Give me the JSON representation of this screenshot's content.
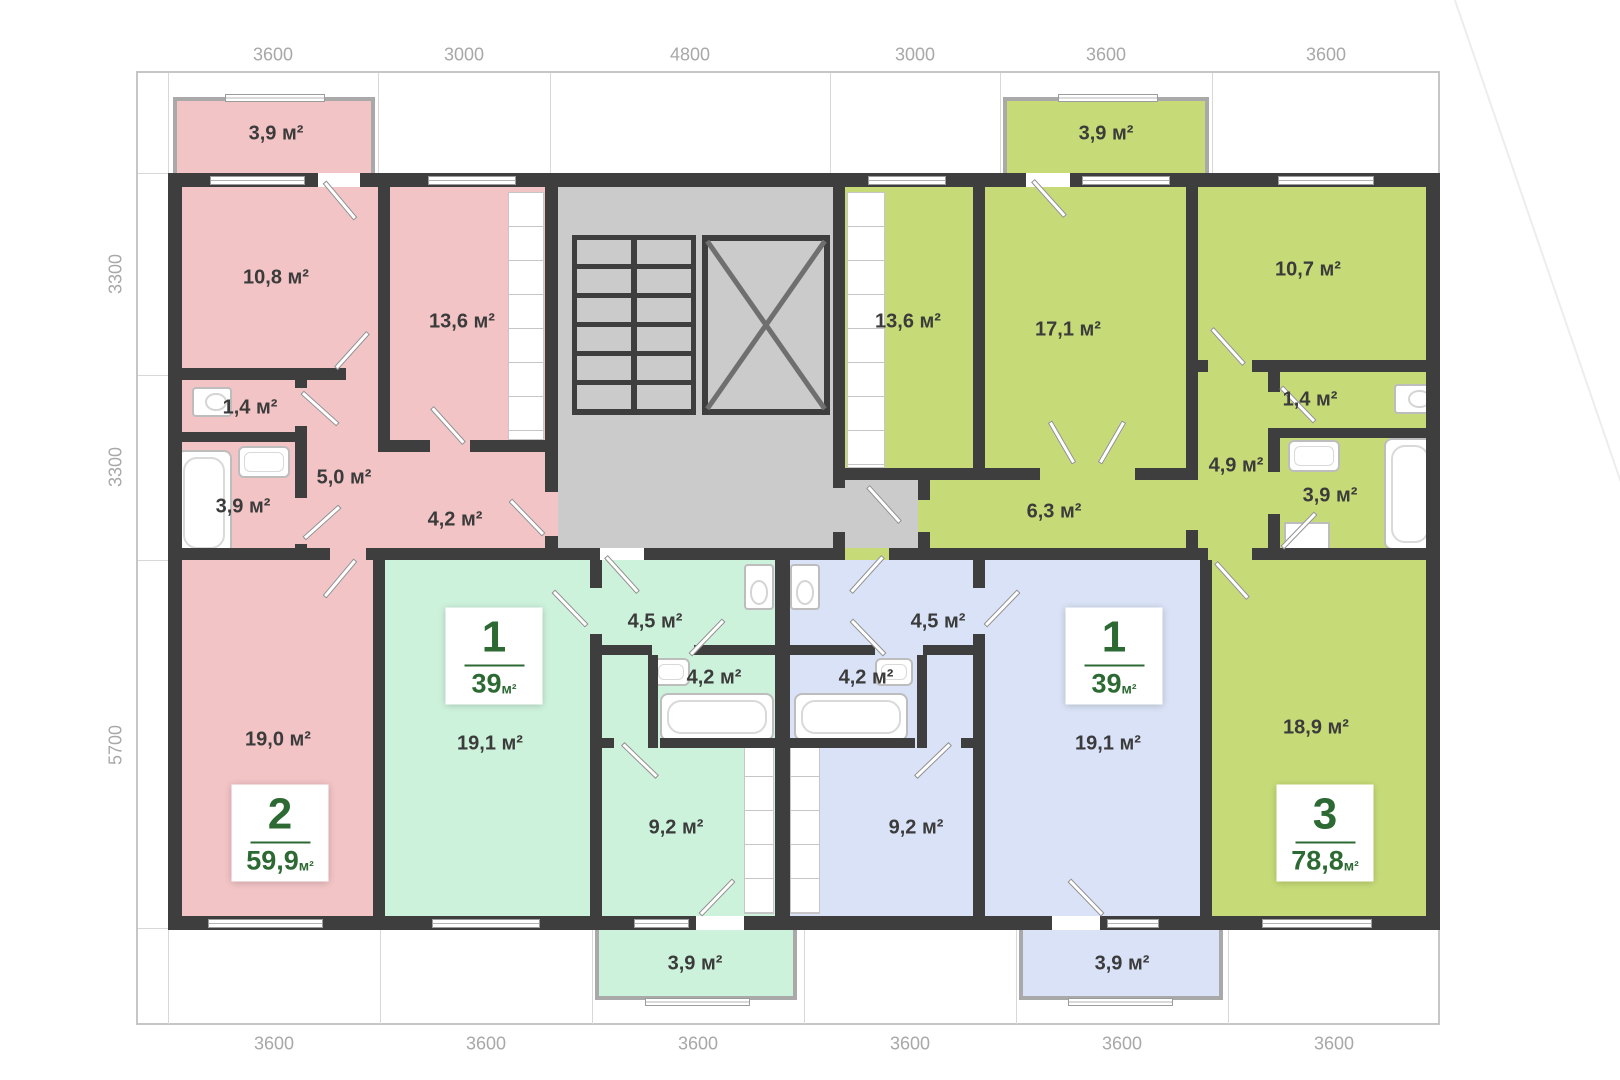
{
  "colors": {
    "wall": "#3e3e3e",
    "stairwell": "#cbcbcb",
    "apartment_pink": "#f2c4c6",
    "apartment_mint": "#cdf2dc",
    "apartment_blue": "#d9e2f6",
    "apartment_lime": "#c6db78",
    "badge_green": "#2d6a33",
    "dimension_text": "#a8a8a8",
    "room_label_text": "#3b3b3b"
  },
  "dimensions": {
    "top": [
      "3600",
      "3000",
      "4800",
      "3000",
      "3600",
      "3600"
    ],
    "left": [
      "3300",
      "3300",
      "5700"
    ],
    "bottom": [
      "3600",
      "3600",
      "3600",
      "3600",
      "3600",
      "3600"
    ]
  },
  "apartments": [
    {
      "name": "two-room-apartment-pink",
      "badge": {
        "number": "2",
        "area": "59,9",
        "unit": "м²"
      },
      "rooms": [
        {
          "name": "balcony",
          "label": "3,9 м²"
        },
        {
          "name": "bedroom",
          "label": "10,8 м²"
        },
        {
          "name": "kitchen",
          "label": "13,6 м²"
        },
        {
          "name": "wc",
          "label": "1,4 м²"
        },
        {
          "name": "hall",
          "label": "5,0 м²"
        },
        {
          "name": "bathroom",
          "label": "3,9 м²"
        },
        {
          "name": "corridor",
          "label": "4,2 м²"
        },
        {
          "name": "living-room",
          "label": "19,0 м²"
        }
      ]
    },
    {
      "name": "one-room-apartment-mint",
      "badge": {
        "number": "1",
        "area": "39",
        "unit": "м²"
      },
      "rooms": [
        {
          "name": "living-room",
          "label": "19,1 м²"
        },
        {
          "name": "hall",
          "label": "4,5 м²"
        },
        {
          "name": "bathroom",
          "label": "4,2 м²"
        },
        {
          "name": "kitchen",
          "label": "9,2 м²"
        },
        {
          "name": "balcony",
          "label": "3,9 м²"
        }
      ]
    },
    {
      "name": "one-room-apartment-blue",
      "badge": {
        "number": "1",
        "area": "39",
        "unit": "м²"
      },
      "rooms": [
        {
          "name": "hall",
          "label": "4,5 м²"
        },
        {
          "name": "bathroom",
          "label": "4,2 м²"
        },
        {
          "name": "living-room",
          "label": "19,1 м²"
        },
        {
          "name": "kitchen",
          "label": "9,2 м²"
        },
        {
          "name": "balcony",
          "label": "3,9 м²"
        }
      ]
    },
    {
      "name": "three-room-apartment-lime",
      "badge": {
        "number": "3",
        "area": "78,8",
        "unit": "м²"
      },
      "rooms": [
        {
          "name": "balcony",
          "label": "3,9 м²"
        },
        {
          "name": "kitchen",
          "label": "13,6 м²"
        },
        {
          "name": "bedroom",
          "label": "17,1 м²"
        },
        {
          "name": "bedroom-2",
          "label": "10,7 м²"
        },
        {
          "name": "wc",
          "label": "1,4 м²"
        },
        {
          "name": "hall",
          "label": "4,9 м²"
        },
        {
          "name": "bathroom",
          "label": "3,9 м²"
        },
        {
          "name": "corridor",
          "label": "6,3 м²"
        },
        {
          "name": "living-room",
          "label": "18,9 м²"
        }
      ]
    }
  ]
}
